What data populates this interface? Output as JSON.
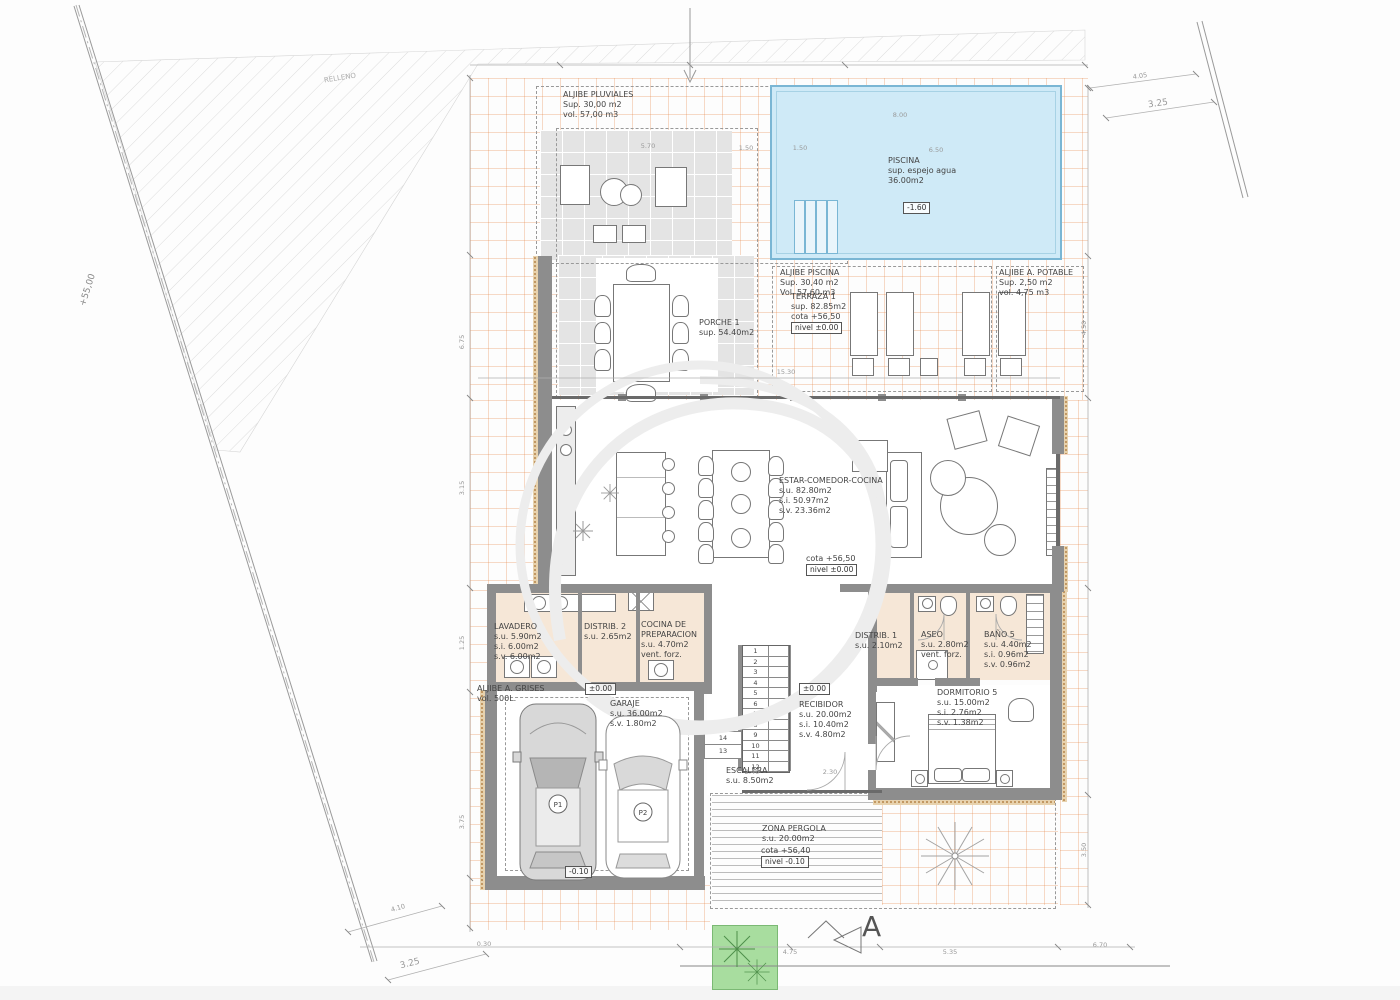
{
  "site": {
    "relleno": "RELLENO",
    "level": "+55,00",
    "section_letter": "A"
  },
  "rooms": {
    "aljibe_pluviales": {
      "name": "ALJIBE PLUVIALES",
      "lines": [
        "Sup. 30,00 m2",
        "vol. 57,00 m3"
      ]
    },
    "piscina": {
      "name": "PISCINA",
      "lines": [
        "sup. espejo agua",
        "36.00m2"
      ],
      "depth": "-1.60"
    },
    "aljibe_piscina": {
      "name": "ALJIBE PISCINA",
      "lines": [
        "Sup. 30,40 m2",
        "Vol. 57,60 m3"
      ]
    },
    "aljibe_potable": {
      "name": "ALJIBE A. POTABLE",
      "lines": [
        "Sup. 2,50 m2",
        "vol. 4,75 m3"
      ]
    },
    "terraza1": {
      "name": "TERRAZA 1",
      "lines": [
        "sup. 82.85m2",
        "cota +56,50"
      ],
      "nivel": "nivel ±0.00"
    },
    "porche1": {
      "name": "PORCHE 1",
      "lines": [
        "sup. 54.40m2"
      ]
    },
    "estar": {
      "name": "ESTAR-COMEDOR-COCINA",
      "lines": [
        "s.u. 82.80m2",
        "s.i. 50.97m2",
        "s.v. 23.36m2"
      ],
      "cota": "cota +56,50",
      "nivel": "nivel ±0.00"
    },
    "lavadero": {
      "name": "LAVADERO",
      "lines": [
        "s.u. 5.90m2",
        "s.i. 6.00m2",
        "s.v. 6.00m2"
      ]
    },
    "distrib2": {
      "name": "DISTRIB. 2",
      "lines": [
        "s.u. 2.65m2"
      ]
    },
    "cocina_prep": {
      "name": "COCINA DE",
      "name2": "PREPARACION",
      "lines": [
        "s.u. 4.70m2",
        "vent. forz."
      ]
    },
    "aljibe_grises": {
      "name": "ALJIBE A. GRISES",
      "lines": [
        "vol. 500L."
      ]
    },
    "garaje": {
      "name": "GARAJE",
      "lines": [
        "s.u. 36.00m2",
        "s.v. 1.80m2"
      ],
      "level_top": "±0.00",
      "level_bottom": "-0.10",
      "p1": "P1",
      "p2": "P2"
    },
    "escalera": {
      "name": "ESCALERA",
      "lines": [
        "s.u. 8.50m2"
      ]
    },
    "recibidor": {
      "name": "RECIBIDOR",
      "lines": [
        "s.u. 20.00m2",
        "s.i. 10.40m2",
        "s.v. 4.80m2"
      ],
      "nivel": "±0.00"
    },
    "distrib1": {
      "name": "DISTRIB. 1",
      "lines": [
        "s.u. 2.10m2"
      ]
    },
    "aseo": {
      "name": "ASEO",
      "lines": [
        "s.u. 2.80m2",
        "vent. forz."
      ]
    },
    "bano5": {
      "name": "BAÑO 5",
      "lines": [
        "s.u. 4.40m2",
        "s.i. 0.96m2",
        "s.v. 0.96m2"
      ]
    },
    "dormitorio5": {
      "name": "DORMITORIO 5",
      "lines": [
        "s.u. 15.00m2",
        "s.i. 2.76m2",
        "s.v. 1.38m2"
      ]
    },
    "zona_pergola": {
      "name": "ZONA PERGOLA",
      "lines": [
        "s.u. 20.00m2"
      ],
      "cota": "cota +56,40",
      "nivel": "nivel -0.10"
    }
  },
  "stairs": {
    "main": [
      "1",
      "2",
      "3",
      "4",
      "5",
      "6",
      "7",
      "8",
      "9",
      "10",
      "11",
      "12"
    ],
    "extra": [
      "14",
      "13"
    ]
  },
  "dims": [
    "5.70",
    "1.50",
    "1.50",
    "6.50",
    "15.30",
    "4.05",
    "3.25",
    "4.10",
    "3.25",
    "4.75",
    "5.35",
    "6.70",
    "6.75",
    "3.15",
    "1.25",
    "3.75",
    "4.50",
    "3.50",
    "2.40",
    "2.30",
    "0.30",
    "8.00"
  ],
  "colors": {
    "pool": "#cfeaf7",
    "pool_edge": "#7ab6d4",
    "wall": "#8d8d8d",
    "tile_line": "#e68c50",
    "paving": "#e4e4e4",
    "room_floor": "#f6e7d7",
    "green": "#a8dd9f",
    "cork_dot": "#bb8c54"
  }
}
